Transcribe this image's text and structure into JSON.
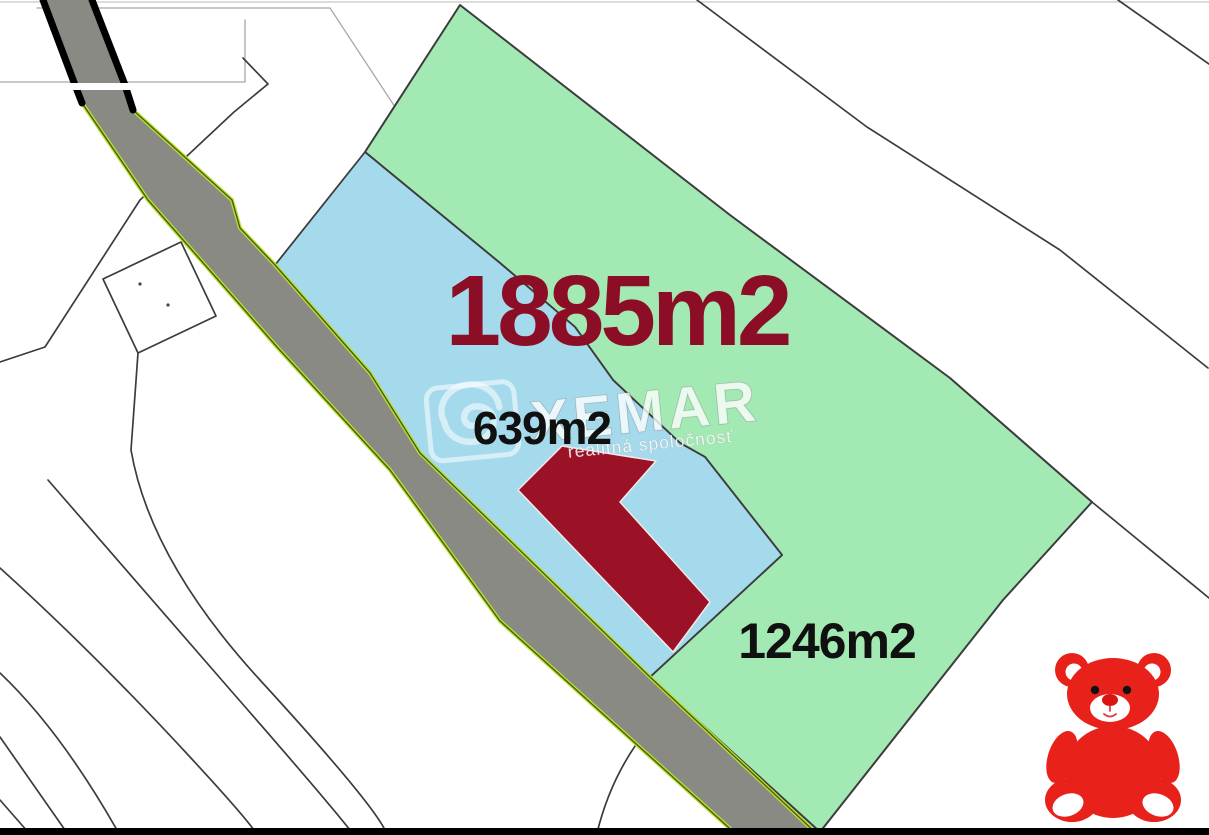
{
  "map": {
    "labels": {
      "area_total": "1885m2",
      "area_blue": "639m2",
      "area_green": "1246m2"
    },
    "watermark": {
      "brand": "XEMAR",
      "subtitle": "realitná spoločnosť"
    },
    "icons": {
      "teddy_bear": "red-teddy-bear-mascot",
      "logo_spiral": "xemar-spiral-logo"
    },
    "colors": {
      "background": "#ffffff",
      "parcel_green": "#a3e9b3",
      "parcel_blue": "#a5d9ec",
      "building": "#9b1126",
      "building_halo": "#f2e9ea",
      "road": "#8a8a85",
      "road_edge_top": "#000000",
      "road_edge_outer": "#c9d834",
      "road_edge_inner": "#2e6c10",
      "boundary": "#3c3c3c",
      "boundary_faint": "#a8a8a8",
      "frame_top": "#c6c6c6",
      "label_total": "#8c0e26",
      "label_dark": "#101010",
      "bear_red": "#e8211a",
      "bear_nose": "#d81510",
      "border_bottom": "#000000"
    }
  }
}
